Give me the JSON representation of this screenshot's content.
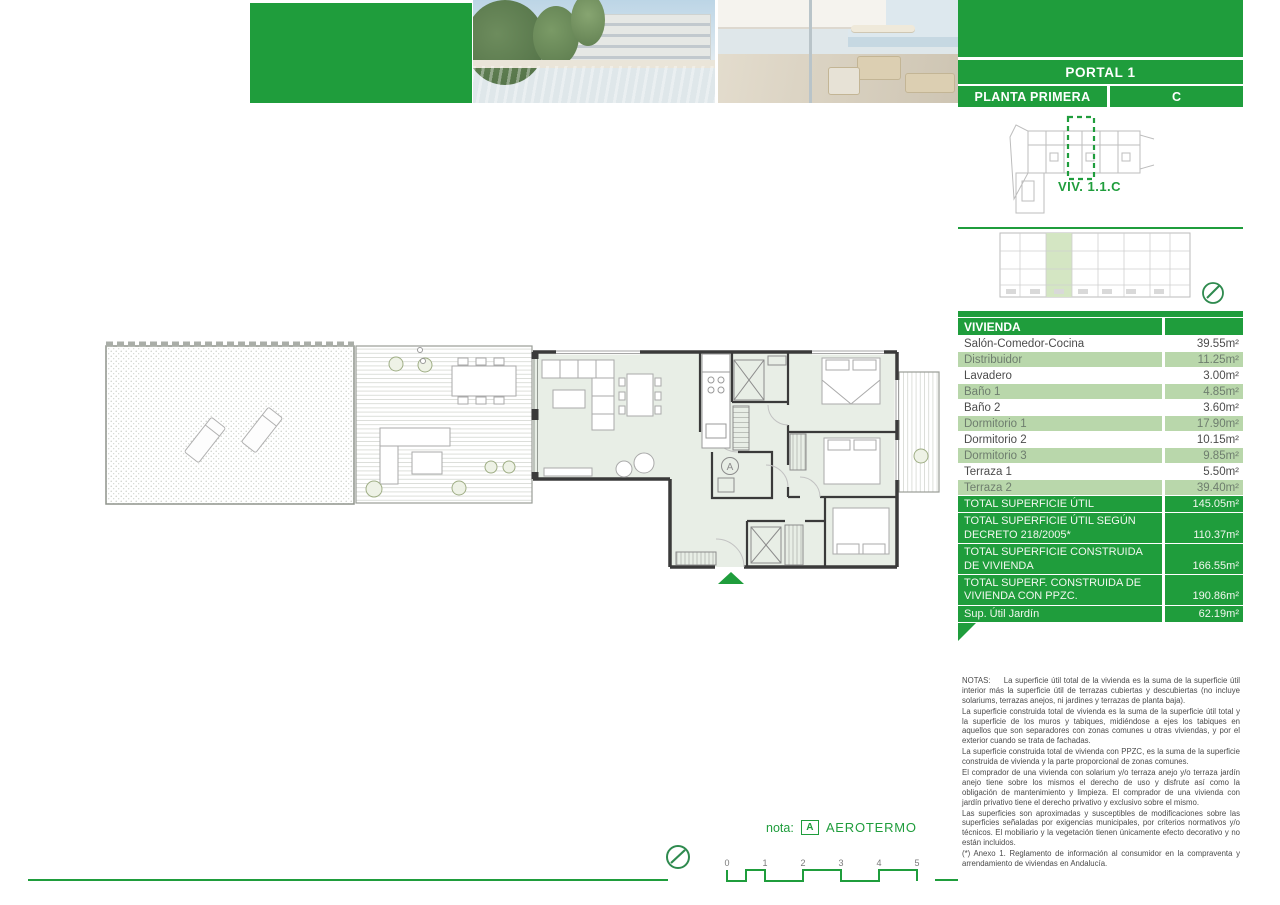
{
  "header": {
    "portal": "PORTAL 1",
    "planta": "PLANTA PRIMERA",
    "letter": "C",
    "unit_label": "VIV. 1.1.C"
  },
  "surface_table": {
    "header": "VIVIENDA",
    "rows": [
      {
        "label": "Salón-Comedor-Cocina",
        "value": "39.55m²"
      },
      {
        "label": "Distribuidor",
        "value": "11.25m²"
      },
      {
        "label": "Lavadero",
        "value": "3.00m²"
      },
      {
        "label": "Baño 1",
        "value": "4.85m²"
      },
      {
        "label": "Baño 2",
        "value": "3.60m²"
      },
      {
        "label": "Dormitorio 1",
        "value": "17.90m²"
      },
      {
        "label": "Dormitorio 2",
        "value": "10.15m²"
      },
      {
        "label": "Dormitorio 3",
        "value": "9.85m²"
      },
      {
        "label": "Terraza 1",
        "value": "5.50m²"
      },
      {
        "label": "Terraza 2",
        "value": "39.40m²"
      }
    ],
    "totals": [
      {
        "label": "TOTAL SUPERFICIE ÚTIL",
        "value": "145.05m²"
      },
      {
        "label": "TOTAL SUPERFICIE ÚTIL SEGÚN DECRETO 218/2005*",
        "value": "110.37m²"
      },
      {
        "label": "TOTAL SUPERFICIE CONSTRUIDA DE VIVIENDA",
        "value": "166.55m²"
      },
      {
        "label": "TOTAL SUPERF. CONSTRUIDA DE VIVIENDA CON PPZC.",
        "value": "190.86m²"
      },
      {
        "label": "Sup. Útil Jardín",
        "value": "62.19m²"
      }
    ]
  },
  "notes": {
    "paragraphs": [
      "NOTAS:     La superficie útil total de la vivienda es la suma de la superficie útil interior más la superficie útil de terrazas cubiertas y descubiertas (no incluye solariums, terrazas anejos, ni jardines y terrazas de planta baja).",
      "La superficie construida total de vivienda es la suma de la superficie útil total y la superficie de los muros y tabiques, midiéndose a ejes los tabiques en aquellos que son separadores con zonas comunes u otras viviendas, y por el exterior cuando se trata de fachadas.",
      "La superficie construida total de vivienda con PPZC, es la suma de la superficie construida de vivienda y la parte proporcional de zonas comunes.",
      "El comprador de una vivienda con solarium y/o terraza anejo y/o terraza jardín anejo tiene sobre los mismos el derecho de uso y disfrute así como la obligación de mantenimiento y limpieza. El comprador de una vivienda con jardín privativo tiene el derecho privativo y exclusivo sobre el mismo.",
      "Las superficies son aproximadas y susceptibles de modificaciones sobre las superficies señaladas por exigencias municipales, por criterios normativos y/o técnicos. El mobiliario y la vegetación tienen únicamente efecto decorativo y no están incluidos.",
      "(*) Anexo 1. Reglamento de información al consumidor en la compraventa y arrendamiento de viviendas en Andalucía."
    ]
  },
  "footer": {
    "nota_label": "nota:",
    "aerotermo_box": "A",
    "aerotermo_label": "AEROTERMO",
    "scale_ticks": [
      "0",
      "1",
      "2",
      "3",
      "4",
      "5"
    ]
  },
  "plan": {
    "aerotermo_label": "A"
  },
  "colors": {
    "green": "#1f9d3c",
    "light_green_row": "#b9d7ab",
    "highlight": "#d4e6c3",
    "floor": "#e8eee6"
  }
}
